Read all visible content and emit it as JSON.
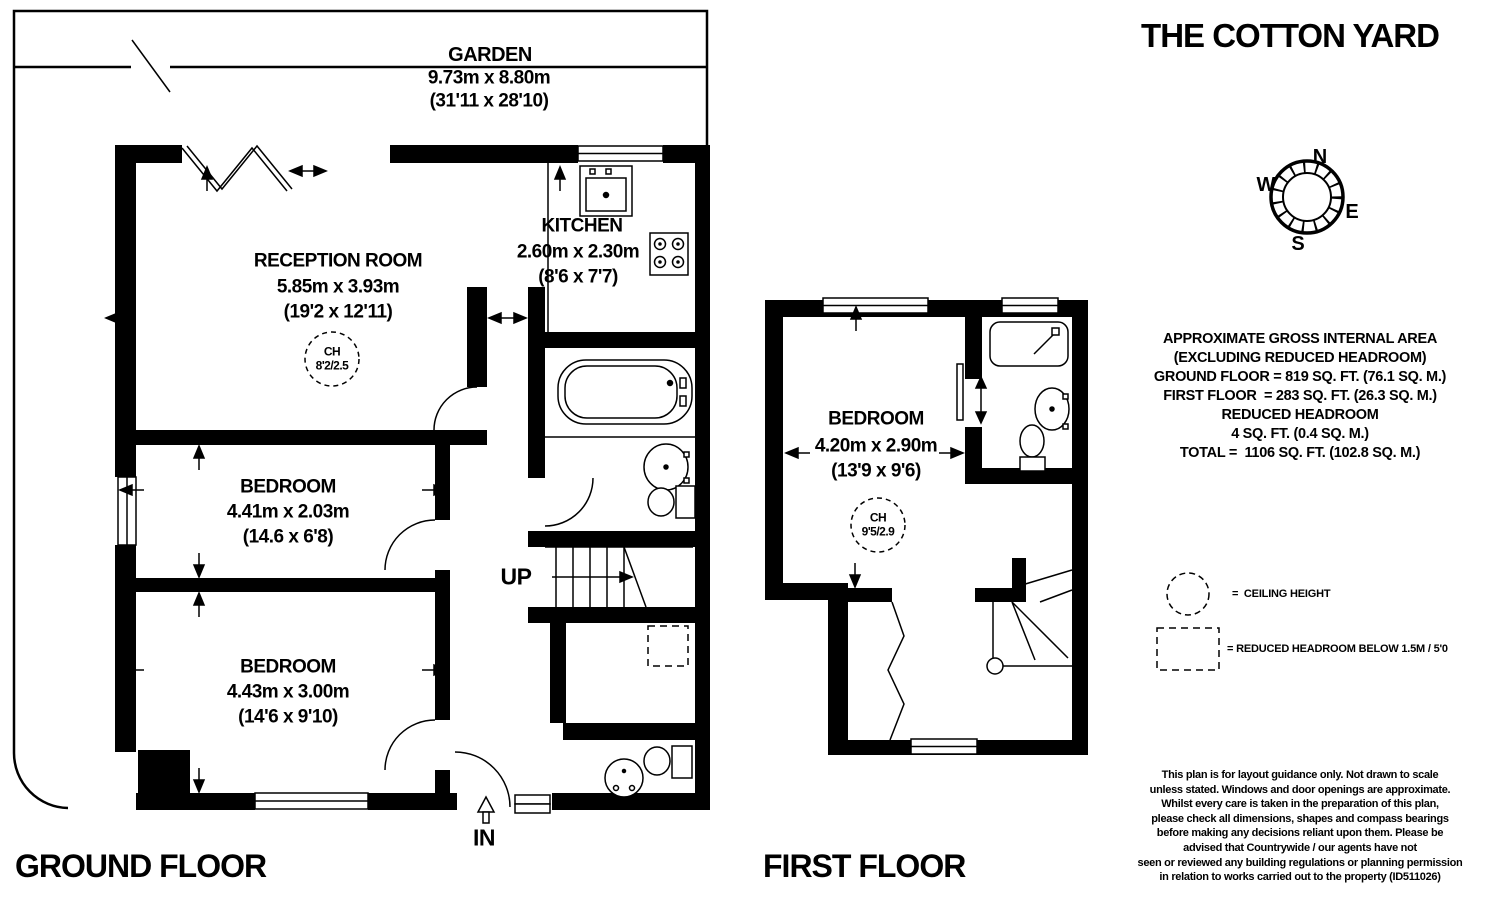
{
  "title": "THE COTTON YARD",
  "colors": {
    "ink": "#000000",
    "paper": "#ffffff"
  },
  "garden": {
    "name": "GARDEN",
    "metric": "9.73m x 8.80m",
    "imperial": "(31'11 x 28'10)"
  },
  "floors": {
    "ground": {
      "label": "GROUND FLOOR"
    },
    "first": {
      "label": "FIRST FLOOR"
    }
  },
  "rooms": {
    "reception": {
      "name": "RECEPTION ROOM",
      "metric": "5.85m x 3.93m",
      "imperial": "(19'2 x 12'11)",
      "ch": "CH",
      "ch_value": "8'2/2.5"
    },
    "kitchen": {
      "name": "KITCHEN",
      "metric": "2.60m x 2.30m",
      "imperial": "(8'6 x 7'7)"
    },
    "gf_bedroom_1": {
      "name": "BEDROOM",
      "metric": "4.41m x 2.03m",
      "imperial": "(14.6 x 6'8)"
    },
    "gf_bedroom_2": {
      "name": "BEDROOM",
      "metric": "4.43m x 3.00m",
      "imperial": "(14'6 x 9'10)"
    },
    "ff_bedroom": {
      "name": "BEDROOM",
      "metric": "4.20m x 2.90m",
      "imperial": "(13'9 x 9'6)",
      "ch": "CH",
      "ch_value": "9'5/2.9"
    }
  },
  "annotations": {
    "stairs_up": "UP",
    "entrance_in": "IN"
  },
  "compass": {
    "n": "N",
    "e": "E",
    "s": "S",
    "w": "W"
  },
  "areas": {
    "lines": [
      "APPROXIMATE GROSS INTERNAL AREA",
      "(EXCLUDING REDUCED HEADROOM)",
      "GROUND FLOOR = 819 SQ. FT. (76.1 SQ. M.)",
      "FIRST FLOOR  = 283 SQ. FT. (26.3 SQ. M.)",
      "REDUCED HEADROOM",
      "4 SQ. FT. (0.4 SQ. M.)",
      "TOTAL =  1106 SQ. FT. (102.8 SQ. M.)"
    ]
  },
  "legend": {
    "ceiling_height": "=  CEILING HEIGHT",
    "reduced_headroom": "= REDUCED HEADROOM BELOW 1.5M / 5'0"
  },
  "disclaimer": {
    "lines": [
      "This plan is for layout guidance only. Not drawn to scale",
      "unless stated. Windows and door openings are approximate.",
      "Whilst every care is taken in the preparation of this plan,",
      "please check all dimensions, shapes and compass bearings",
      "before making any decisions reliant upon them. Please be",
      "advised that Countrywide / our agents have not",
      "seen or reviewed any building regulations or planning permission",
      "in relation to works carried out to the property (ID511026)"
    ]
  }
}
